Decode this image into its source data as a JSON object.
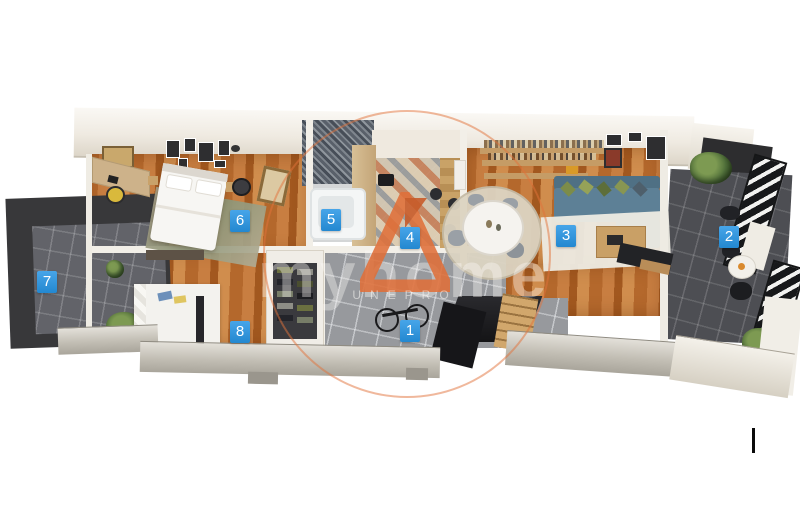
{
  "scene": {
    "kind": "isometric apartment floor plan render",
    "background": "#ffffff"
  },
  "room_labels": [
    {
      "number": "1"
    },
    {
      "number": "2"
    },
    {
      "number": "3"
    },
    {
      "number": "4"
    },
    {
      "number": "5"
    },
    {
      "number": "6"
    },
    {
      "number": "7"
    },
    {
      "number": "8"
    }
  ],
  "label_style": {
    "background": "#2f97de",
    "text_color": "#ffffff"
  },
  "watermark": {
    "word": "myhome",
    "logo_text": "UNEPRO",
    "accent_color": "#e0703a"
  }
}
